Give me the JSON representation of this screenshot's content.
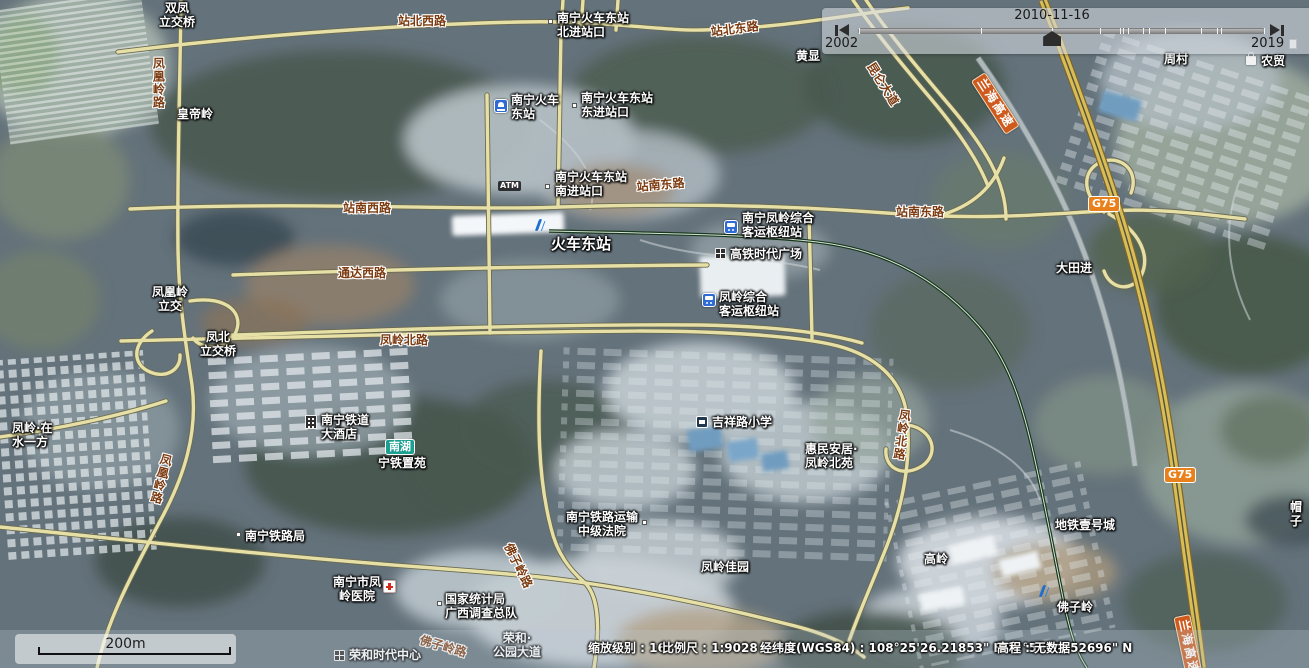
{
  "timeline": {
    "current_date": "2010-11-16",
    "start_year": "2002",
    "end_year": "2019",
    "handle_pct": 47.7,
    "ticks_pct": [
      0,
      30,
      47.7,
      59.5,
      64.4,
      65.3,
      66.3,
      70,
      71.5,
      75.5,
      84.5,
      88.3,
      89.5,
      100
    ]
  },
  "scale_bar": {
    "distance_label": "200m"
  },
  "status_bar": {
    "zoom_label": "缩放级别 : 16",
    "scale_label": "比例尺 : 1:9028",
    "coordinates_label": "经纬度(WGS84) : 108°25'26.21853\" E  22°50'49.52696\" N",
    "elevation_label": "高程 : 无数据"
  },
  "colors": {
    "road_fill": "#e7e0a6",
    "road_casing": "#6a6a50",
    "highway_fill": "#d8bc55",
    "highway_casing": "#7c6630",
    "railway": "#17381c",
    "road_label": "#7c3b10",
    "highway_badge": "#cf5a1e",
    "g75_badge": "#e8811c",
    "metro_badge": "#1a9f90"
  },
  "map_labels": [
    {
      "text": "双凤\n立交桥",
      "x": 146,
      "y": 1,
      "type": "place",
      "ctr": 1,
      "w": 62
    },
    {
      "text": "皇帝岭",
      "x": 177,
      "y": 107,
      "type": "place"
    },
    {
      "text": "南宁火车东站\n北进站口",
      "x": 557,
      "y": 11,
      "type": "place"
    },
    {
      "text": "黄显",
      "x": 796,
      "y": 49,
      "type": "place"
    },
    {
      "text": "周村",
      "x": 1164,
      "y": 52,
      "type": "place"
    },
    {
      "text": "农贸",
      "x": 1261,
      "y": 54,
      "type": "place"
    },
    {
      "text": "南宁火车\n东站",
      "x": 511,
      "y": 93,
      "type": "place"
    },
    {
      "text": "南宁火车东站\n东进站口",
      "x": 581,
      "y": 91,
      "type": "place"
    },
    {
      "text": "南宁火车东站\n南进站口",
      "x": 555,
      "y": 170,
      "type": "place"
    },
    {
      "text": "火车东站",
      "x": 551,
      "y": 235,
      "type": "place",
      "fs": 15
    },
    {
      "text": "南宁凤岭综合\n客运枢纽站",
      "x": 742,
      "y": 211,
      "type": "place"
    },
    {
      "text": "高铁时代广场",
      "x": 730,
      "y": 247,
      "type": "place"
    },
    {
      "text": "大田进",
      "x": 1056,
      "y": 261,
      "type": "place"
    },
    {
      "text": "凤凰岭\n立交",
      "x": 144,
      "y": 285,
      "type": "place",
      "ctr": 1,
      "w": 52
    },
    {
      "text": "凤北\n立交桥",
      "x": 193,
      "y": 330,
      "type": "place",
      "ctr": 1,
      "w": 50
    },
    {
      "text": "凤岭综合\n客运枢纽站",
      "x": 719,
      "y": 290,
      "type": "place"
    },
    {
      "text": "凤岭·在\n水一方",
      "x": 12,
      "y": 421,
      "type": "place"
    },
    {
      "text": "南宁铁道\n大酒店",
      "x": 321,
      "y": 413,
      "type": "place"
    },
    {
      "text": "宁铁置苑",
      "x": 378,
      "y": 456,
      "type": "place"
    },
    {
      "text": "南宁铁路局",
      "x": 245,
      "y": 529,
      "type": "place"
    },
    {
      "text": "吉祥路小学",
      "x": 712,
      "y": 415,
      "type": "place"
    },
    {
      "text": "惠民安居·\n凤岭北苑",
      "x": 805,
      "y": 442,
      "type": "place"
    },
    {
      "text": "南宁铁路运输\n中级法院",
      "x": 560,
      "y": 510,
      "type": "place",
      "ctr": 1,
      "w": 84
    },
    {
      "text": "凤岭佳园",
      "x": 701,
      "y": 560,
      "type": "place"
    },
    {
      "text": "地铁壹号城",
      "x": 1055,
      "y": 518,
      "type": "place"
    },
    {
      "text": "高岭",
      "x": 924,
      "y": 552,
      "type": "place"
    },
    {
      "text": "佛子岭",
      "x": 1057,
      "y": 600,
      "type": "place"
    },
    {
      "text": "南宁市凤\n岭医院",
      "x": 331,
      "y": 575,
      "type": "place",
      "ctr": 1,
      "w": 52
    },
    {
      "text": "国家统计局\n广西调查总队",
      "x": 445,
      "y": 592,
      "type": "place"
    },
    {
      "text": "荣和时代中心",
      "x": 349,
      "y": 648,
      "type": "place"
    },
    {
      "text": "荣和·\n公园大道",
      "x": 486,
      "y": 631,
      "type": "place",
      "ctr": 1,
      "w": 62
    },
    {
      "text": "帽子",
      "x": 1290,
      "y": 500,
      "type": "place"
    },
    {
      "text": "站北西路",
      "x": 398,
      "y": 14,
      "type": "road"
    },
    {
      "text": "站北东路",
      "x": 710,
      "y": 25,
      "type": "road",
      "rot": -7
    },
    {
      "text": "站南西路",
      "x": 343,
      "y": 201,
      "type": "road"
    },
    {
      "text": "站南东路",
      "x": 636,
      "y": 180,
      "type": "road",
      "rot": -5
    },
    {
      "text": "站南东路",
      "x": 896,
      "y": 205,
      "type": "road"
    },
    {
      "text": "通达西路",
      "x": 338,
      "y": 266,
      "type": "road"
    },
    {
      "text": "凤岭北路",
      "x": 380,
      "y": 333,
      "type": "road"
    },
    {
      "text": "凤凰岭路",
      "x": 151,
      "y": 57,
      "type": "road",
      "v": 1
    },
    {
      "text": "凤凰岭路",
      "x": 160,
      "y": 452,
      "type": "road",
      "v": 1,
      "rot": 14
    },
    {
      "text": "凤岭北路",
      "x": 898,
      "y": 408,
      "type": "road",
      "v": 1,
      "rot": 8
    },
    {
      "text": "佛子岭路",
      "x": 514,
      "y": 541,
      "type": "road",
      "rot": 64
    },
    {
      "text": "佛子岭路",
      "x": 422,
      "y": 633,
      "type": "road",
      "rot": 16
    },
    {
      "text": "昆仑大道",
      "x": 876,
      "y": 60,
      "type": "road",
      "rot": 58
    },
    {
      "text": "兰海高速",
      "x": 985,
      "y": 72,
      "type": "hwy",
      "rot": 57
    },
    {
      "text": "兰海高速",
      "x": 1190,
      "y": 614,
      "type": "hwy",
      "rot": 78
    },
    {
      "text": "G75",
      "x": 1088,
      "y": 196,
      "type": "g75"
    },
    {
      "text": "G75",
      "x": 1164,
      "y": 467,
      "type": "g75"
    },
    {
      "text": "南湖",
      "x": 385,
      "y": 439,
      "type": "metro"
    },
    {
      "text": "ATM",
      "x": 498,
      "y": 181,
      "type": "dark"
    }
  ],
  "map_icons": [
    {
      "name": "railway-station-icon",
      "x": 494,
      "y": 99
    },
    {
      "name": "metro-logo-icon",
      "x": 535,
      "y": 218
    },
    {
      "name": "metro-logo-icon",
      "x": 1039,
      "y": 584
    },
    {
      "name": "bus-station-icon",
      "x": 724,
      "y": 220
    },
    {
      "name": "bus-station-icon",
      "x": 702,
      "y": 293
    },
    {
      "name": "building-icon",
      "x": 715,
      "y": 248
    },
    {
      "name": "building-icon",
      "x": 334,
      "y": 650
    },
    {
      "name": "hotel-icon",
      "x": 305,
      "y": 415
    },
    {
      "name": "school-icon",
      "x": 696,
      "y": 416
    },
    {
      "name": "hospital-icon",
      "x": 383,
      "y": 580
    },
    {
      "name": "shop-icon",
      "x": 1246,
      "y": 52
    },
    {
      "name": "partial-icon",
      "x": 1289,
      "y": 39
    },
    {
      "name": "poi-dot",
      "x": 548,
      "y": 19
    },
    {
      "name": "poi-dot",
      "x": 572,
      "y": 103
    },
    {
      "name": "poi-dot",
      "x": 545,
      "y": 184
    },
    {
      "name": "poi-dot",
      "x": 236,
      "y": 532
    },
    {
      "name": "poi-dot",
      "x": 642,
      "y": 520
    },
    {
      "name": "poi-dot",
      "x": 437,
      "y": 601
    }
  ]
}
